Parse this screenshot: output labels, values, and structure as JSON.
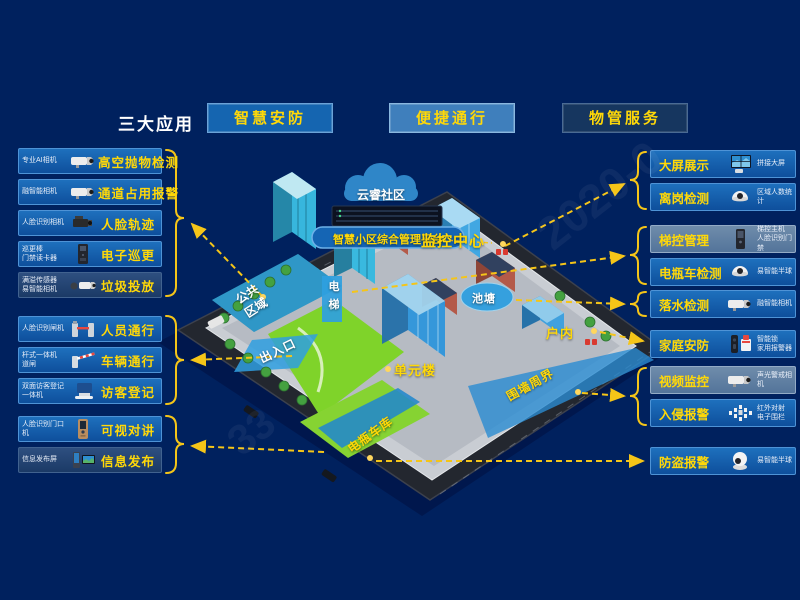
{
  "header": {
    "section_label": "三大应用",
    "apps": [
      {
        "label": "智慧安防"
      },
      {
        "label": "便捷通行"
      },
      {
        "label": "物管服务"
      }
    ]
  },
  "left_panel": {
    "groups": [
      {
        "items": [
          {
            "device": "专业AI相机",
            "feature": "高空抛物检测",
            "icon": "bullet-camera",
            "style": ""
          },
          {
            "device": "融智能相机",
            "feature": "通道占用报警",
            "icon": "bullet-camera",
            "style": ""
          },
          {
            "device": "人脸识别相机",
            "feature": "人脸轨迹",
            "icon": "box-camera",
            "style": ""
          },
          {
            "device": "巡更棒\n门禁读卡器",
            "feature": "电子巡更",
            "icon": "card-reader",
            "style": ""
          },
          {
            "device": "满溢传感器\n易智能相机",
            "feature": "垃圾投放",
            "icon": "sensor-camera",
            "style": "dark"
          }
        ]
      },
      {
        "items": [
          {
            "device": "人脸识别闸机",
            "feature": "人员通行",
            "icon": "turnstile",
            "style": ""
          },
          {
            "device": "杆式一体机\n道闸",
            "feature": "车辆通行",
            "icon": "barrier-gate",
            "style": ""
          },
          {
            "device": "双面访客登记\n一体机",
            "feature": "访客登记",
            "icon": "visitor-terminal",
            "style": ""
          }
        ]
      },
      {
        "items": [
          {
            "device": "人脸识别门口\n机",
            "feature": "可视对讲",
            "icon": "door-station",
            "style": ""
          },
          {
            "device": "信息发布屏",
            "feature": "信息发布",
            "icon": "info-screens",
            "style": "dark"
          }
        ]
      }
    ]
  },
  "right_panel": {
    "groups": [
      {
        "items": [
          {
            "feature": "大屏展示",
            "device": "拼接大屏",
            "icon": "video-wall",
            "style": ""
          },
          {
            "feature": "离岗检测",
            "device": "区域人数统计",
            "icon": "dome-camera",
            "style": ""
          }
        ]
      },
      {
        "items": [
          {
            "feature": "梯控管理",
            "device": "梯控主机\n人脸识别门禁",
            "icon": "elevator-host",
            "style": "light"
          },
          {
            "feature": "电瓶车检测",
            "device": "易智能半球",
            "icon": "dome-camera",
            "style": ""
          }
        ]
      },
      {
        "items": [
          {
            "feature": "落水检测",
            "device": "融智能相机",
            "icon": "bullet-camera",
            "style": ""
          }
        ]
      },
      {
        "items": [
          {
            "feature": "家庭安防",
            "device": "智能锁\n家用报警器",
            "icon": "smart-lock-alarm",
            "style": ""
          }
        ]
      },
      {
        "items": [
          {
            "feature": "视频监控",
            "device": "声光警戒相机",
            "icon": "bullet-camera",
            "style": "light"
          },
          {
            "feature": "入侵报警",
            "device": "红外对射\n电子围栏",
            "icon": "fence",
            "style": ""
          }
        ]
      },
      {
        "items": [
          {
            "feature": "防盗报警",
            "device": "易智能半球",
            "icon": "turret-camera",
            "style": ""
          }
        ]
      }
    ]
  },
  "map": {
    "cloud_label": "云睿社区",
    "platform_label": "智慧小区综合管理平台",
    "labels": {
      "monitor_center": "监控中心",
      "elevator": "电梯",
      "pond": "池塘",
      "public_area": "公共\n区域",
      "entrance": "出入口",
      "unit_building": "单元楼",
      "indoor": "户内",
      "perimeter": "围墙周界",
      "ebike_garage": "电瓶车库"
    }
  },
  "watermark": {
    "text1": "2020-0",
    "text2": "33"
  },
  "colors": {
    "background": "#00215e",
    "accent_yellow": "#ffd808",
    "connector_yellow": "#f5c518",
    "card_blue": "#1565b0",
    "highlight_blue": "#2f9fe0"
  }
}
